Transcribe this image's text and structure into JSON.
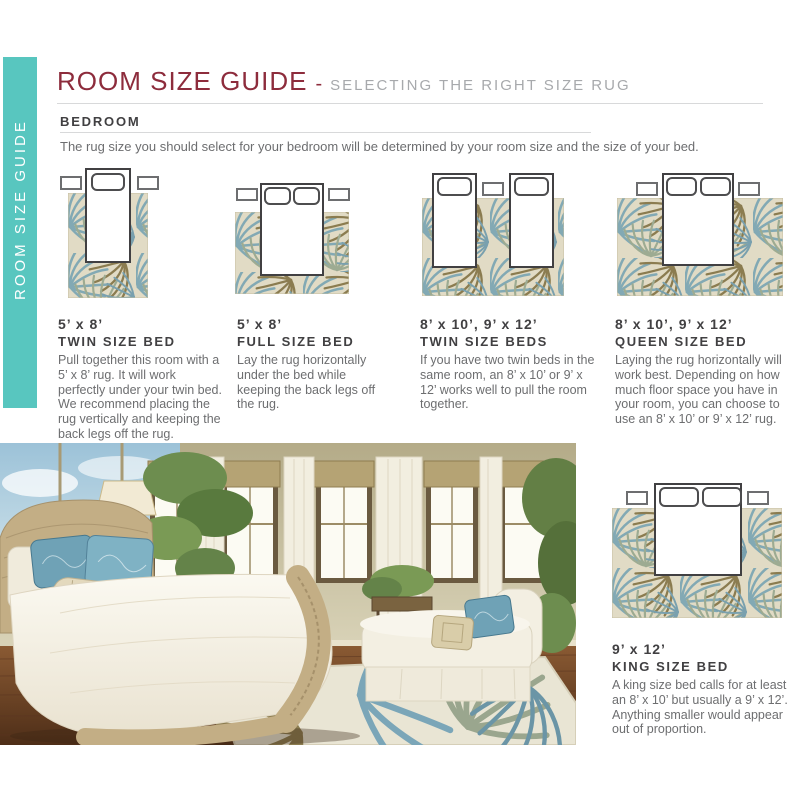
{
  "sidebar": {
    "label": "ROOM SIZE GUIDE",
    "bg_color": "#58c6bf",
    "text_color": "#ffffff"
  },
  "header": {
    "title": "ROOM SIZE GUIDE",
    "dash": "-",
    "subtitle": "SELECTING THE RIGHT SIZE RUG",
    "title_color": "#8d2c3c",
    "subtitle_color": "#a7a9ac"
  },
  "section": {
    "heading": "BEDROOM",
    "intro": "The rug size you should select for your bedroom will be determined by your room size and the size of your bed."
  },
  "guides": [
    {
      "size": "5’ x 8’",
      "bed": "TWIN SIZE BED",
      "description": "Pull together this room with a 5’ x 8’ rug. It will work perfectly under your twin bed. We recommend placing the rug vertically and keeping the back legs off the rug."
    },
    {
      "size": "5’ x 8’",
      "bed": "FULL SIZE BED",
      "description": "Lay the rug horizontally under the bed while keeping the back legs off the rug."
    },
    {
      "size": "8’ x 10’, 9’ x 12’",
      "bed": "TWIN SIZE BEDS",
      "description": "If you have two twin beds in the same room, an 8’ x 10’ or 9’ x 12’ works well to pull the room together."
    },
    {
      "size": "8’ x 10’, 9’ x 12’",
      "bed": "QUEEN SIZE BED",
      "description": "Laying the rug horizontally will work best. Depending on how much floor space you have in your room, you can choose to use an 8’ x 10’ or 9’ x 12’ rug."
    },
    {
      "size": "9’ x 12’",
      "bed": "KING SIZE BED",
      "description": "A king size bed calls for at least an 8’ x 10’ but usually a 9’ x 12’. Anything smaller would appear out of proportion."
    }
  ],
  "colors": {
    "accent_teal": "#58c6bf",
    "title_maroon": "#8d2c3c",
    "body_gray": "#6d6e70",
    "heading_gray": "#414042",
    "rug_beige": "#e1dbc5",
    "leaf_blue": "#82a9b4",
    "leaf_olive": "#8b7c50",
    "leaf_sage": "#9dab92"
  }
}
